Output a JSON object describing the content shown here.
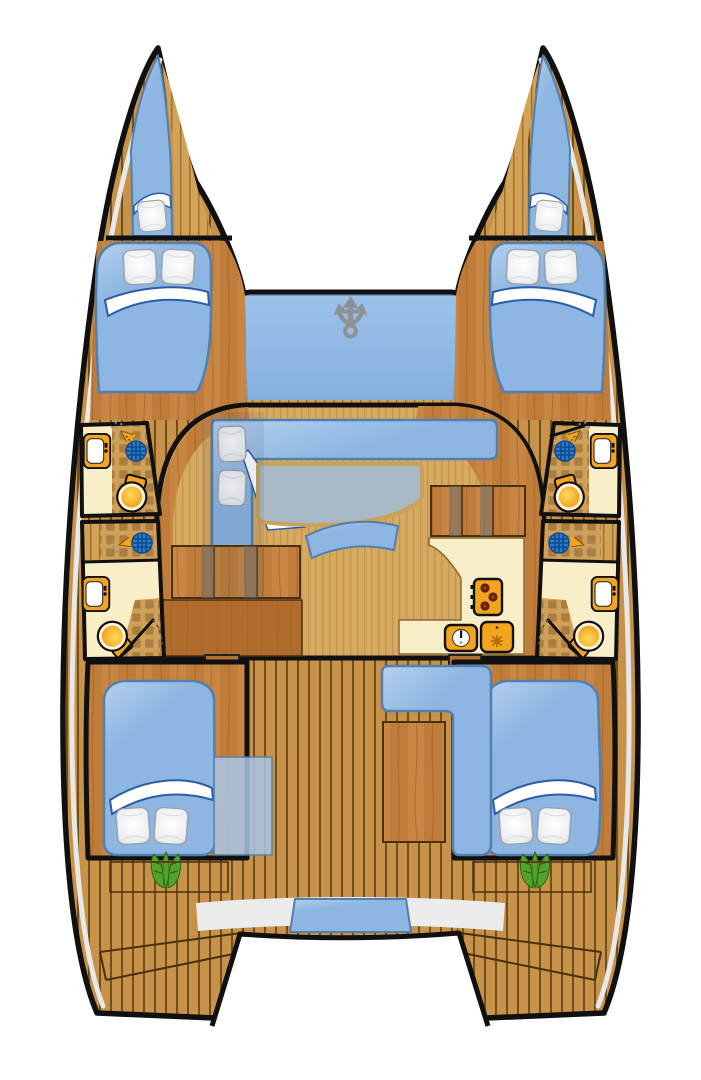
{
  "diagram": {
    "label": "Catamaran yacht accommodation floor plan, top-down view, bow at top",
    "view": "top-down"
  },
  "colors": {
    "outline": "#101010",
    "gunwale": "#e8e8e8",
    "deck_plank": "#c89249",
    "deck_line": "#6e5020",
    "deck2": "#d4a257",
    "deck2_line": "#98702e",
    "hull_wood": "#c07d3a",
    "hull_wood_hi": "#d09050",
    "hull_wood_dark": "#9a5f24",
    "wood2": "#b06c2c",
    "floor": "#d6aa60",
    "floor_line": "#c3944e",
    "tile": "#cfa058",
    "tile_sq": "#ab7d41",
    "counter": "#f8efc9",
    "cushion": "#8db6e2",
    "cushion_hi": "#b5d0ee",
    "cushion_edge": "#517fb0",
    "trampoline_hi": "#9cc2ea",
    "trampoline": "#86b0df",
    "pillow_hi": "#ffffff",
    "pillow_sh": "#c4c8cf",
    "table": "#aab9c6",
    "table_edge": "#c9a25e",
    "toilet_hi": "#ffd95e",
    "toilet": "#ee9510",
    "toilet_rim": "#fdf3d8",
    "fixture": "#f3a51e",
    "drain": "#2b7ccc",
    "drain_dark": "#0d4a8c",
    "plant": "#55a12b",
    "plant_dark": "#246c12",
    "anchor": "#8e9297",
    "bench": "#ececec",
    "step": "#b5722f"
  },
  "inventory": {
    "hulls": 2,
    "bow_berths": 2,
    "double_bed_cabins": 4,
    "bathrooms": 4,
    "toilets": 4,
    "bathroom_sinks": 4,
    "shower_drains": 4,
    "shower_heads": 4,
    "galley_stoves": 1,
    "stove_burners": 3,
    "galley_sinks": 2,
    "salon_sofas": 1,
    "salon_tables": 1,
    "cockpit_benches": 1,
    "cockpit_tables": 1,
    "aft_bench_cushions": 1,
    "trampolines": 1,
    "anchors": 1,
    "plants": 2,
    "stair_flights": 2
  },
  "icons": [
    "anchor-icon",
    "toilet-icon",
    "bathroom-sink-icon",
    "shower-head-icon",
    "shower-drain-icon",
    "stove-icon",
    "galley-sink-icon",
    "icebox-icon",
    "plant-icon",
    "pillow",
    "blanket",
    "bed",
    "stairs",
    "door-arc"
  ]
}
